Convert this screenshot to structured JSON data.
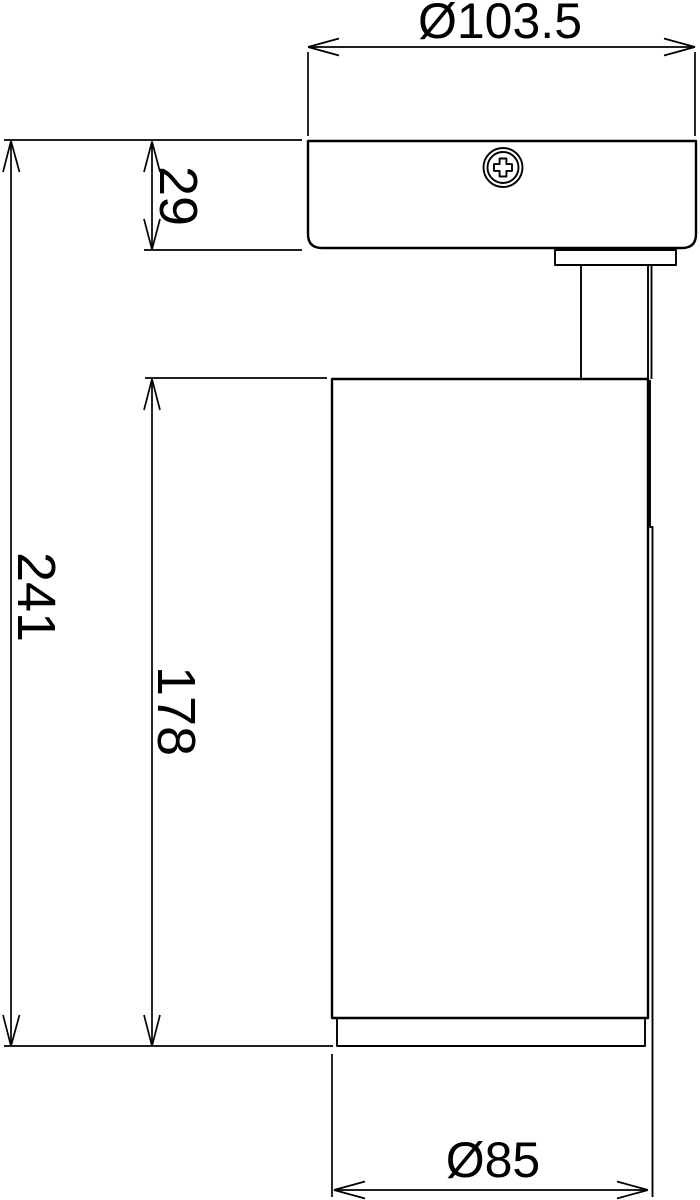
{
  "drawing": {
    "type": "technical-dimension-drawing",
    "subject": "surface-mounted cylindrical spotlight, side view",
    "background_color": "#ffffff",
    "line_color": "#000000",
    "labels": {
      "top_diameter": "Ø103.5",
      "canopy_height": "29",
      "overall_height": "241",
      "body_height": "178",
      "bottom_diameter": "Ø85"
    }
  }
}
